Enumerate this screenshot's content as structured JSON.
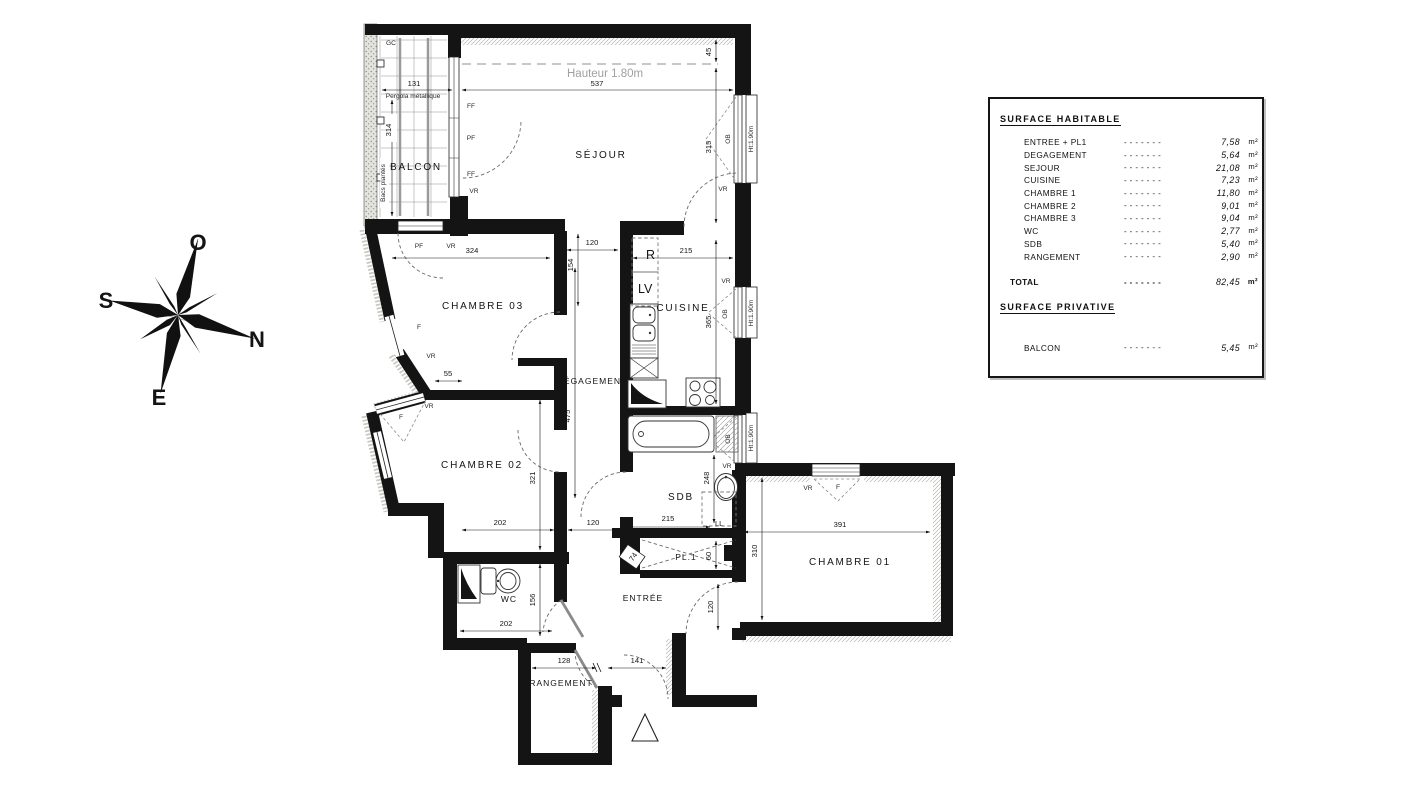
{
  "compass": {
    "o": "O",
    "s": "S",
    "n": "N",
    "e": "E"
  },
  "plan": {
    "rooms": {
      "sejour": "SÉJOUR",
      "balcon": "BALCON",
      "chambre01": "CHAMBRE 01",
      "chambre02": "CHAMBRE 02",
      "chambre03": "CHAMBRE 03",
      "cuisine": "CUISINE",
      "degagement": "DÉGAGEMENT",
      "sdb": "SDB",
      "wc": "WC",
      "entree": "ENTRÉE",
      "rangement": "RANGEMENT",
      "placard": "PL.1"
    },
    "notes": {
      "hauteur": "Hauteur 1.80m",
      "pergola": "Pergola métallique",
      "bacs": "Bacs plantés",
      "gc": "GC",
      "ht190": "Ht:1.90m"
    },
    "openings": {
      "ff": "FF",
      "pf": "PF",
      "vr": "VR",
      "ob": "OB",
      "f": "F"
    },
    "appliances": {
      "r": "R",
      "lv": "LV",
      "ll": "LL"
    },
    "dims": {
      "d45": "45",
      "d55": "55",
      "d60": "60",
      "d74": "74",
      "d120": "120",
      "d128": "128",
      "d131": "131",
      "d141": "141",
      "d154": "154",
      "d156": "156",
      "d202": "202",
      "d215": "215",
      "d248": "248",
      "d310": "310",
      "d314": "314",
      "d315": "315",
      "d321": "321",
      "d324": "324",
      "d365": "365",
      "d391": "391",
      "d475": "475",
      "d537": "537"
    }
  },
  "legend": {
    "habitable_title": "SURFACE HABITABLE",
    "privative_title": "SURFACE PRIVATIVE",
    "total_label": "TOTAL",
    "total_value": "82,45",
    "unit": "m²",
    "dashes": "- - - - - - -",
    "rows": [
      {
        "label": "ENTREE + PL1",
        "value": "7,58"
      },
      {
        "label": "DEGAGEMENT",
        "value": "5,64"
      },
      {
        "label": "SEJOUR",
        "value": "21,08"
      },
      {
        "label": "CUISINE",
        "value": "7,23"
      },
      {
        "label": "CHAMBRE 1",
        "value": "11,80"
      },
      {
        "label": "CHAMBRE 2",
        "value": "9,01"
      },
      {
        "label": "CHAMBRE 3",
        "value": "9,04"
      },
      {
        "label": "WC",
        "value": "2,77"
      },
      {
        "label": "SDB",
        "value": "5,40"
      },
      {
        "label": "RANGEMENT",
        "value": "2,90"
      }
    ],
    "privative_rows": [
      {
        "label": "BALCON",
        "value": "5,45"
      }
    ]
  }
}
